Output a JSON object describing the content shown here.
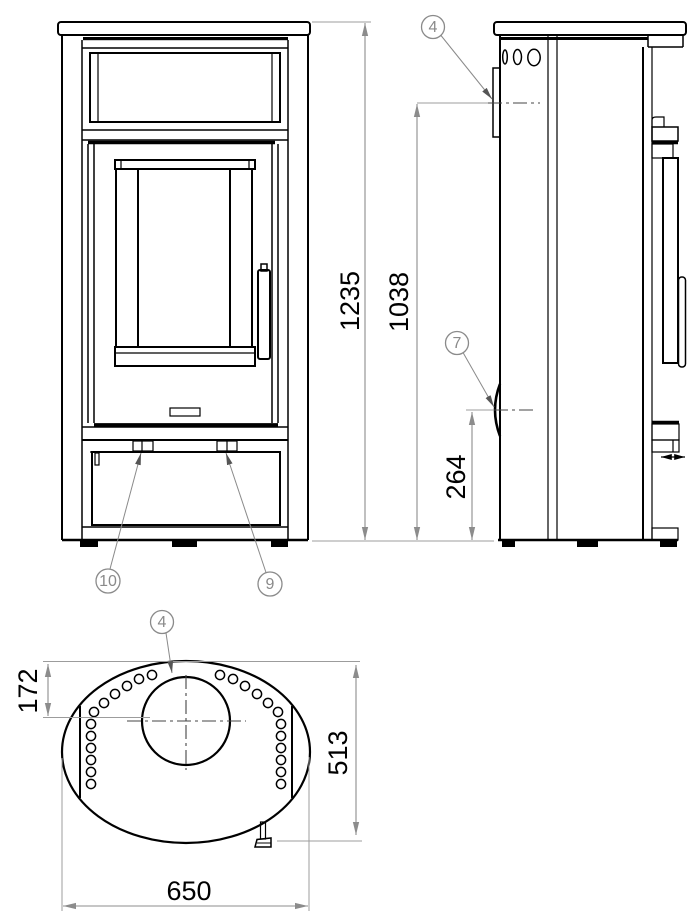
{
  "drawing": {
    "dimensions": {
      "overall_height": "1235",
      "rear_upper_height": "1038",
      "rear_lower_height": "264",
      "flue_center_offset": "172",
      "depth": "513",
      "width": "650"
    },
    "callouts": {
      "side_top": "4",
      "side_rear": "7",
      "front_left": "10",
      "front_right": "9",
      "top_flue": "4"
    },
    "colors": {
      "line": "#000000",
      "dimension": "#8c8c8c",
      "extension": "#9c9c9c",
      "centerline": "#444444",
      "callout": "#8a8a8a",
      "background": "#ffffff"
    }
  }
}
